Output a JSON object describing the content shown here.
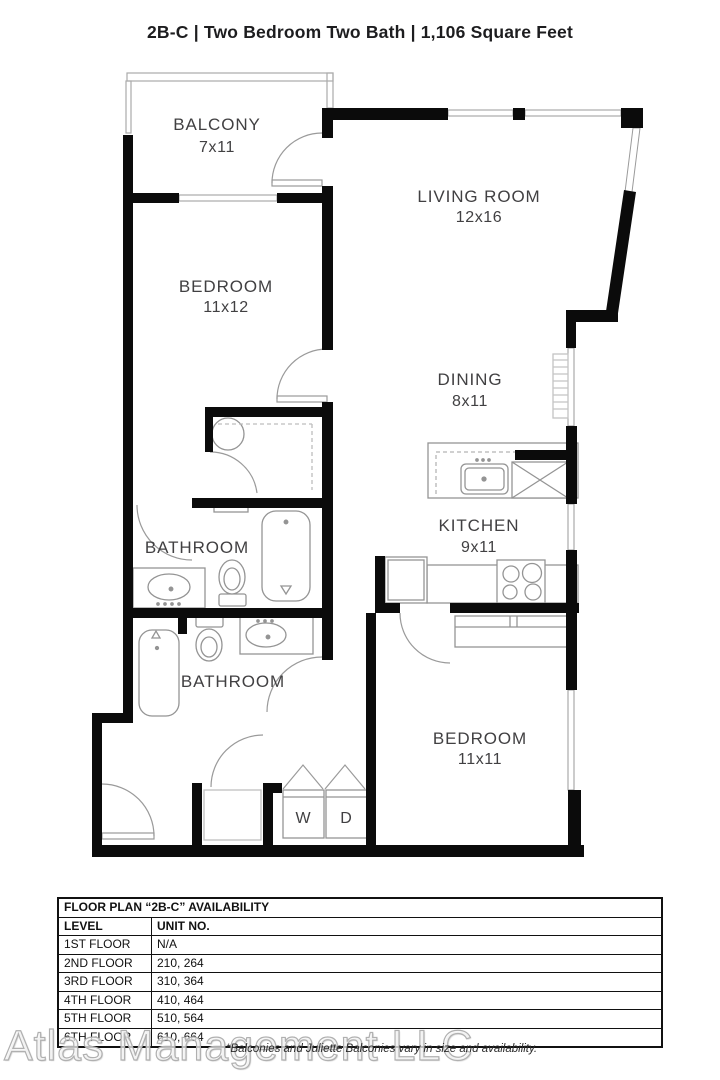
{
  "title": "2B-C | Two Bedroom Two Bath | 1,106 Square Feet",
  "rooms": {
    "balcony": {
      "name": "BALCONY",
      "dims": "7x11"
    },
    "living": {
      "name": "LIVING ROOM",
      "dims": "12x16"
    },
    "bedroom1": {
      "name": "BEDROOM",
      "dims": "11x12"
    },
    "dining": {
      "name": "DINING",
      "dims": "8x11"
    },
    "kitchen": {
      "name": "KITCHEN",
      "dims": "9x11"
    },
    "bath1": {
      "name": "BATHROOM"
    },
    "bath2": {
      "name": "BATHROOM"
    },
    "bedroom2": {
      "name": "BEDROOM",
      "dims": "11x11"
    },
    "washer": "W",
    "dryer": "D"
  },
  "availability_table": {
    "title": "FLOOR PLAN “2B-C” AVAILABILITY",
    "columns": [
      "LEVEL",
      "UNIT NO."
    ],
    "rows": [
      {
        "level": "1ST FLOOR",
        "units": "N/A"
      },
      {
        "level": "2ND FLOOR",
        "units": "210, 264"
      },
      {
        "level": "3RD FLOOR",
        "units": "310, 364"
      },
      {
        "level": "4TH FLOOR",
        "units": "410, 464"
      },
      {
        "level": "5TH FLOOR",
        "units": "510, 564"
      },
      {
        "level": "6TH FLOOR",
        "units": "610, 664"
      }
    ]
  },
  "watermark": "Atlas Management LLC",
  "disclaimer": "*Balconies and Juliette Balconies vary in size and availability.",
  "colors": {
    "wall": "#0b0b0b",
    "fixture": "#949494",
    "label": "#414042"
  }
}
